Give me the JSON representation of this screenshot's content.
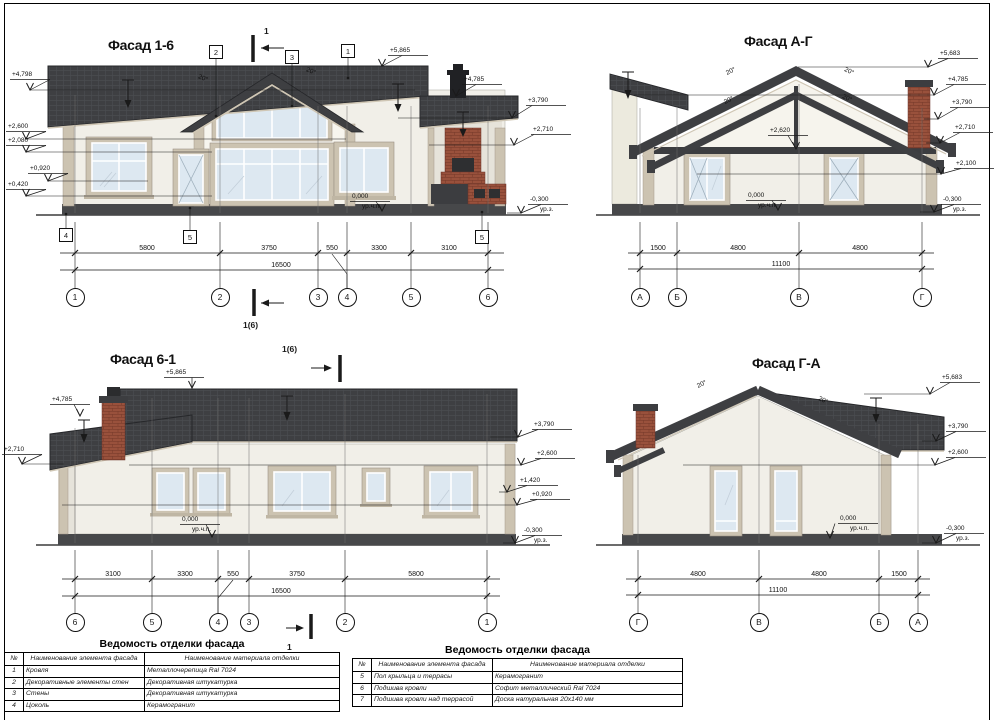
{
  "colors": {
    "roof": "#3e3f42",
    "wall": "#f1efe8",
    "gable_wall": "#f6f4ed",
    "trim": "#ccc3b1",
    "glass": "#dde8f1",
    "plinth": "#47484a",
    "brick": "#99513c",
    "line": "#1a1a1a"
  },
  "facades": {
    "f16": {
      "title": "Фасад 1-6",
      "axis_y": 297,
      "marks": [
        {
          "t": "+4,798",
          "x": 12,
          "y": 71,
          "tx": 30,
          "ty": 90,
          "lw": 385
        },
        {
          "t": "+2,600",
          "x": 8,
          "y": 123,
          "tx": 26,
          "ty": 139,
          "lw": 320
        },
        {
          "t": "+2,080",
          "x": 8,
          "y": 137,
          "tx": 26,
          "ty": 152,
          "lw": 186
        },
        {
          "t": "+0,920",
          "x": 30,
          "y": 165,
          "tx": 48,
          "ty": 181,
          "lw": 100
        },
        {
          "t": "+0,420",
          "x": 8,
          "y": 181,
          "tx": 26,
          "ty": 196,
          "lw": 186
        },
        {
          "t": "+5,865",
          "x": 390,
          "y": 47,
          "tx": 382,
          "ty": 66,
          "lw": 0
        },
        {
          "t": "+4,785",
          "x": 464,
          "y": 76,
          "tx": 456,
          "ty": 96,
          "lw": 0
        },
        {
          "t": "+3,790",
          "x": 528,
          "y": 97,
          "tx": 512,
          "ty": 118,
          "lw": -114
        },
        {
          "t": "+2,710",
          "x": 533,
          "y": 126,
          "tx": 514,
          "ty": 145,
          "lw": -85
        },
        {
          "t": "-0,300",
          "s": "ур.з.",
          "x": 530,
          "y": 196,
          "tx": 521,
          "ty": 213,
          "lw": -14
        },
        {
          "t": "0,000",
          "s": "ур.ч.п.",
          "x": 352,
          "y": 193,
          "tx": 382,
          "ty": 211,
          "lw": 0,
          "dd": -6
        }
      ],
      "dims": [
        {
          "t": "5800",
          "x": 147,
          "y": 245
        },
        {
          "t": "3750",
          "x": 269,
          "y": 245
        },
        {
          "t": "550",
          "x": 332,
          "y": 245
        },
        {
          "t": "3300",
          "x": 379,
          "y": 245
        },
        {
          "t": "3100",
          "x": 449,
          "y": 245
        },
        {
          "t": "16500",
          "x": 281,
          "y": 262
        }
      ],
      "axes": [
        {
          "t": "1",
          "x": 75
        },
        {
          "t": "2",
          "x": 220
        },
        {
          "t": "3",
          "x": 318
        },
        {
          "t": "4",
          "x": 347
        },
        {
          "t": "5",
          "x": 411
        },
        {
          "t": "6",
          "x": 488
        }
      ],
      "callouts": [
        {
          "t": "2",
          "x": 209,
          "y": 45
        },
        {
          "t": "3",
          "x": 285,
          "y": 50
        },
        {
          "t": "1",
          "x": 341,
          "y": 44
        },
        {
          "t": "4",
          "x": 59,
          "y": 228
        },
        {
          "t": "5",
          "x": 183,
          "y": 230
        },
        {
          "t": "5",
          "x": 475,
          "y": 230
        }
      ],
      "sections": [
        {
          "t": "1",
          "x": 264,
          "y": 26
        },
        {
          "t": "1(6)",
          "x": 243,
          "y": 320
        }
      ],
      "slopes": [
        {
          "t": "20°",
          "x": 198,
          "y": 75,
          "r": 22
        },
        {
          "t": "20°",
          "x": 306,
          "y": 68,
          "r": 22
        }
      ]
    },
    "fAG": {
      "title": "Фасад А-Г",
      "axis_y": 297,
      "marks": [
        {
          "t": "+5,683",
          "x": 940,
          "y": 50,
          "tx": 928,
          "ty": 67,
          "lw": -130
        },
        {
          "t": "+4,785",
          "x": 948,
          "y": 76,
          "tx": 934,
          "ty": 95,
          "lw": -300
        },
        {
          "t": "+3,790",
          "x": 952,
          "y": 99,
          "tx": 938,
          "ty": 119,
          "lw": -14
        },
        {
          "t": "+2,710",
          "x": 955,
          "y": 124,
          "tx": 940,
          "ty": 143,
          "lw": -14
        },
        {
          "t": "+2,100",
          "x": 956,
          "y": 160,
          "tx": 941,
          "ty": 174,
          "lw": -244
        },
        {
          "t": "-0,300",
          "s": "ур.з.",
          "x": 943,
          "y": 196,
          "tx": 934,
          "ty": 212,
          "lw": -14
        },
        {
          "t": "+2,620",
          "x": 770,
          "y": 127,
          "tx": 796,
          "ty": 149,
          "lw": 0,
          "dd": -8
        },
        {
          "t": "0,000",
          "s": "ур.ч.п.",
          "x": 748,
          "y": 192,
          "tx": 778,
          "ty": 210,
          "lw": 0,
          "dd": -6
        }
      ],
      "dims": [
        {
          "t": "1500",
          "x": 658,
          "y": 245
        },
        {
          "t": "4800",
          "x": 738,
          "y": 245
        },
        {
          "t": "4800",
          "x": 860,
          "y": 245
        },
        {
          "t": "11100",
          "x": 781,
          "y": 261
        }
      ],
      "axes": [
        {
          "t": "А",
          "x": 640
        },
        {
          "t": "Б",
          "x": 677
        },
        {
          "t": "В",
          "x": 799
        },
        {
          "t": "Г",
          "x": 922
        }
      ],
      "callouts": [],
      "sections": [],
      "slopes": [
        {
          "t": "20°",
          "x": 726,
          "y": 68,
          "r": -26
        },
        {
          "t": "20°",
          "x": 844,
          "y": 68,
          "r": 26
        },
        {
          "t": "20°",
          "x": 724,
          "y": 97,
          "r": -26
        },
        {
          "t": "20°",
          "x": 842,
          "y": 95,
          "r": 26
        }
      ]
    },
    "f61": {
      "title": "Фасад 6-1",
      "axis_y": 622,
      "marks": [
        {
          "t": "+5,865",
          "x": 166,
          "y": 369,
          "tx": 192,
          "ty": 388,
          "lw": 0,
          "dd": 0
        },
        {
          "t": "+4,785",
          "x": 52,
          "y": 396,
          "tx": 80,
          "ty": 416,
          "lw": 0,
          "dd": -6
        },
        {
          "t": "+2,710",
          "x": 4,
          "y": 446,
          "tx": 22,
          "ty": 464,
          "lw": 42
        },
        {
          "t": "+3,790",
          "x": 534,
          "y": 421,
          "tx": 518,
          "ty": 437,
          "lw": -28
        },
        {
          "t": "+2,600",
          "x": 537,
          "y": 450,
          "tx": 521,
          "ty": 465,
          "lw": -392
        },
        {
          "t": "+1,420",
          "x": 520,
          "y": 477,
          "tx": 507,
          "ty": 492,
          "lw": -8
        },
        {
          "t": "+0,920",
          "x": 532,
          "y": 491,
          "tx": 517,
          "ty": 505,
          "lw": -455
        },
        {
          "t": "-0,300",
          "s": "ур.з.",
          "x": 524,
          "y": 527,
          "tx": 515,
          "ty": 543,
          "lw": -12
        },
        {
          "t": "0,000",
          "s": "ур.ч.п.",
          "x": 182,
          "y": 516,
          "tx": 212,
          "ty": 537,
          "lw": 0,
          "dd": -6
        }
      ],
      "dims": [
        {
          "t": "3100",
          "x": 113,
          "y": 571
        },
        {
          "t": "3300",
          "x": 185,
          "y": 571
        },
        {
          "t": "550",
          "x": 233,
          "y": 571
        },
        {
          "t": "3750",
          "x": 297,
          "y": 571
        },
        {
          "t": "5800",
          "x": 416,
          "y": 571
        },
        {
          "t": "16500",
          "x": 281,
          "y": 588
        }
      ],
      "axes": [
        {
          "t": "6",
          "x": 75
        },
        {
          "t": "5",
          "x": 152
        },
        {
          "t": "4",
          "x": 218
        },
        {
          "t": "3",
          "x": 249
        },
        {
          "t": "2",
          "x": 345
        },
        {
          "t": "1",
          "x": 487
        }
      ],
      "callouts": [],
      "sections": [
        {
          "t": "1(6)",
          "x": 282,
          "y": 344
        },
        {
          "t": "1",
          "x": 287,
          "y": 642
        }
      ],
      "slopes": []
    },
    "fGA": {
      "title": "Фасад Г-А",
      "axis_y": 622,
      "marks": [
        {
          "t": "+5,683",
          "x": 942,
          "y": 374,
          "tx": 930,
          "ty": 394,
          "lw": -66
        },
        {
          "t": "+3,790",
          "x": 948,
          "y": 423,
          "tx": 936,
          "ty": 441,
          "lw": -14
        },
        {
          "t": "+2,600",
          "x": 948,
          "y": 449,
          "tx": 935,
          "ty": 465,
          "lw": -252
        },
        {
          "t": "-0,300",
          "s": "ур.з.",
          "x": 946,
          "y": 525,
          "tx": 936,
          "ty": 543,
          "lw": -14
        },
        {
          "t": "0,000",
          "s": "ур.ч.п.",
          "x": 840,
          "y": 515,
          "tx": 830,
          "ty": 538,
          "lw": 0,
          "dd": 5
        }
      ],
      "dims": [
        {
          "t": "4800",
          "x": 698,
          "y": 571
        },
        {
          "t": "4800",
          "x": 819,
          "y": 571
        },
        {
          "t": "1500",
          "x": 899,
          "y": 571
        },
        {
          "t": "11100",
          "x": 778,
          "y": 587
        }
      ],
      "axes": [
        {
          "t": "Г",
          "x": 638
        },
        {
          "t": "В",
          "x": 759
        },
        {
          "t": "Б",
          "x": 879
        },
        {
          "t": "А",
          "x": 918
        }
      ],
      "callouts": [],
      "sections": [],
      "slopes": [
        {
          "t": "20°",
          "x": 697,
          "y": 381,
          "r": -26
        },
        {
          "t": "20°",
          "x": 818,
          "y": 397,
          "r": 26
        }
      ]
    }
  },
  "tables": [
    {
      "title": "Ведомость отделки фасада",
      "headers": [
        "№",
        "Наименование элемента фасада",
        "Наименование материала отделки"
      ],
      "rows": [
        [
          "1",
          "Кровля",
          "Металлочерепица Ral 7024"
        ],
        [
          "2",
          "Декоративные элементы стен",
          "Декоративная штукатурка"
        ],
        [
          "3",
          "Стены",
          "Декоративная штукатурка"
        ],
        [
          "4",
          "Цоколь",
          "Керамогранит"
        ]
      ]
    },
    {
      "title": "Ведомость отделки фасада",
      "headers": [
        "№",
        "Наименование элемента фасада",
        "Наименование материала отделки"
      ],
      "rows": [
        [
          "5",
          "Пол крыльца и террасы",
          "Керамогранит"
        ],
        [
          "6",
          "Подшива кровли",
          "Софит металлический Ral 7024"
        ],
        [
          "7",
          "Подшива кровли над террасой",
          "Доска натуральная 20х140 мм"
        ]
      ]
    }
  ]
}
